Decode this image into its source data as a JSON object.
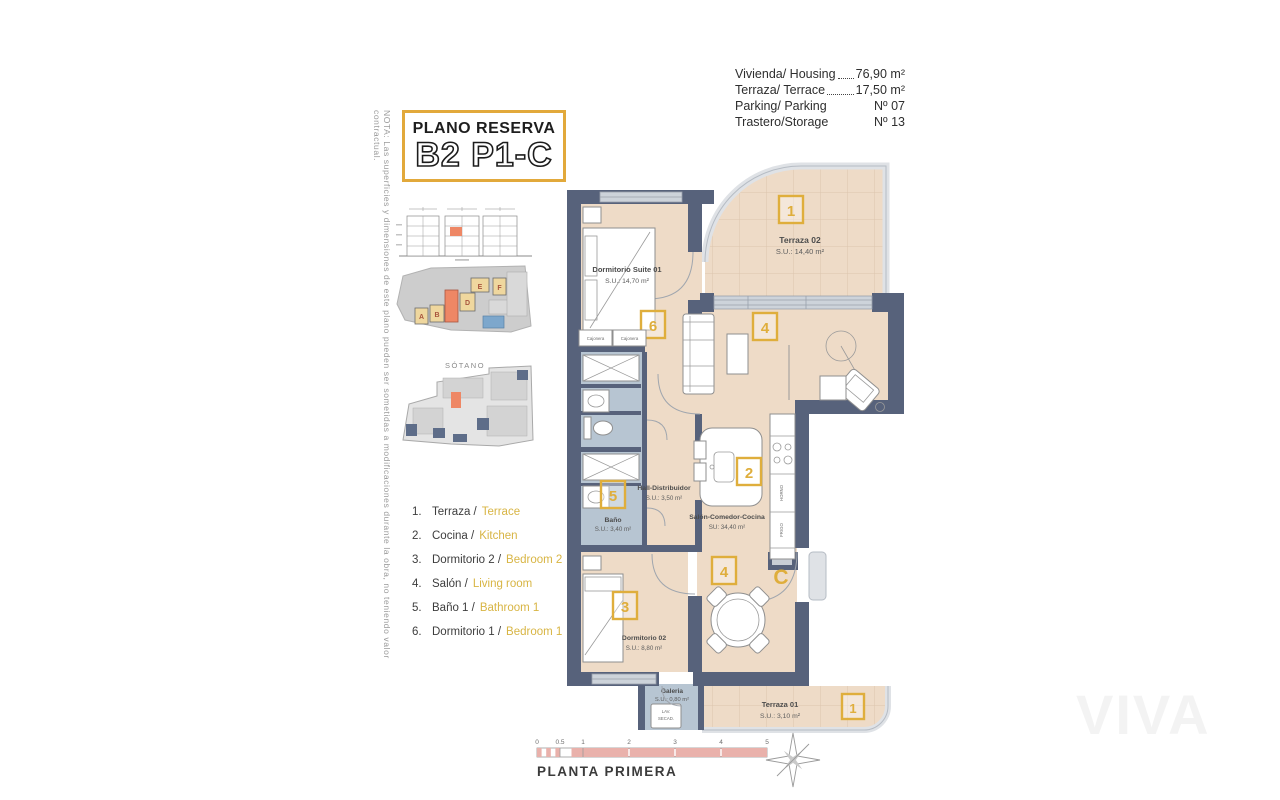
{
  "note": "NOTA: Las superficies y dimensiones de este plano pueden ser sometidas a modificaciones durante la obra, no teniendo valor contractual.",
  "title_block": {
    "line1": "PLANO RESERVA",
    "line2": "B2 P1-C"
  },
  "info": {
    "rows": [
      {
        "label": "Vivienda/ Housing",
        "value": "76,90 m²"
      },
      {
        "label": "Terraza/ Terrace",
        "value": "17,50 m²"
      },
      {
        "label": "Parking/ Parking",
        "value": "Nº 07"
      },
      {
        "label": "Trastero/Storage",
        "value": "Nº 13"
      }
    ]
  },
  "sidebar": {
    "sotano": "SÓTANO",
    "letters": {
      "a": "A",
      "b": "B",
      "d": "D",
      "e": "E",
      "f": "F"
    }
  },
  "legend": {
    "items": [
      {
        "num": "1.",
        "es": "Terraza /",
        "en": "Terrace"
      },
      {
        "num": "2.",
        "es": "Cocina /",
        "en": "Kitchen"
      },
      {
        "num": "3.",
        "es": "Dormitorio 2 /",
        "en": "Bedroom 2"
      },
      {
        "num": "4.",
        "es": "Salón /",
        "en": "Living room"
      },
      {
        "num": "5.",
        "es": "Baño 1 /",
        "en": "Bathroom 1"
      },
      {
        "num": "6.",
        "es": "Dormitorio 1 /",
        "en": "Bedroom 1"
      }
    ]
  },
  "plan": {
    "terraza02": {
      "name": "Terraza 02",
      "area": "S.U.: 14,40 m²",
      "tag": "1"
    },
    "suite": {
      "name": "Dormitorio Suite 01",
      "area": "S.U.: 14,70 m²",
      "tag": "6"
    },
    "hall": {
      "name": "Hall-Distribuidor",
      "area": "S.U.: 3,50 m²"
    },
    "salon": {
      "name": "Salón-Comedor-Cocina",
      "area": "SU: 34,40 m²",
      "tag_living": "4",
      "tag_kitchen": "2",
      "tag_dining": "4"
    },
    "bano": {
      "name": "Baño",
      "area": "S.U.: 3,40 m²",
      "tag": "5"
    },
    "dorm2": {
      "name": "Dormitorio 02",
      "area": "S.U.: 8,80 m²",
      "tag": "3"
    },
    "galeria": {
      "name": "Galeria",
      "area": "S.U.: 0,80 m²",
      "lav": "LAV.",
      "secad": "SECAD."
    },
    "terraza01": {
      "name": "Terraza 01",
      "area": "S.U.: 3,10 m²",
      "tag": "1"
    },
    "entry": "C",
    "cajonera": "Cajonera",
    "horno": "HORNO",
    "frigo": "FRIGO"
  },
  "footer": {
    "ticks": [
      "0",
      "0.5",
      "1",
      "2",
      "3",
      "4",
      "5"
    ],
    "name": "PLANTA PRIMERA"
  },
  "watermark": "VIVA",
  "colors": {
    "accent_gold": "#dfae3c",
    "legend_gold": "#d8b544",
    "wall": "#57627b",
    "floor": "#eedbc7",
    "wet_zone": "#b7c5d2",
    "highlight_orange": "#ee8765",
    "scale_pink": "#e9b1ab"
  }
}
